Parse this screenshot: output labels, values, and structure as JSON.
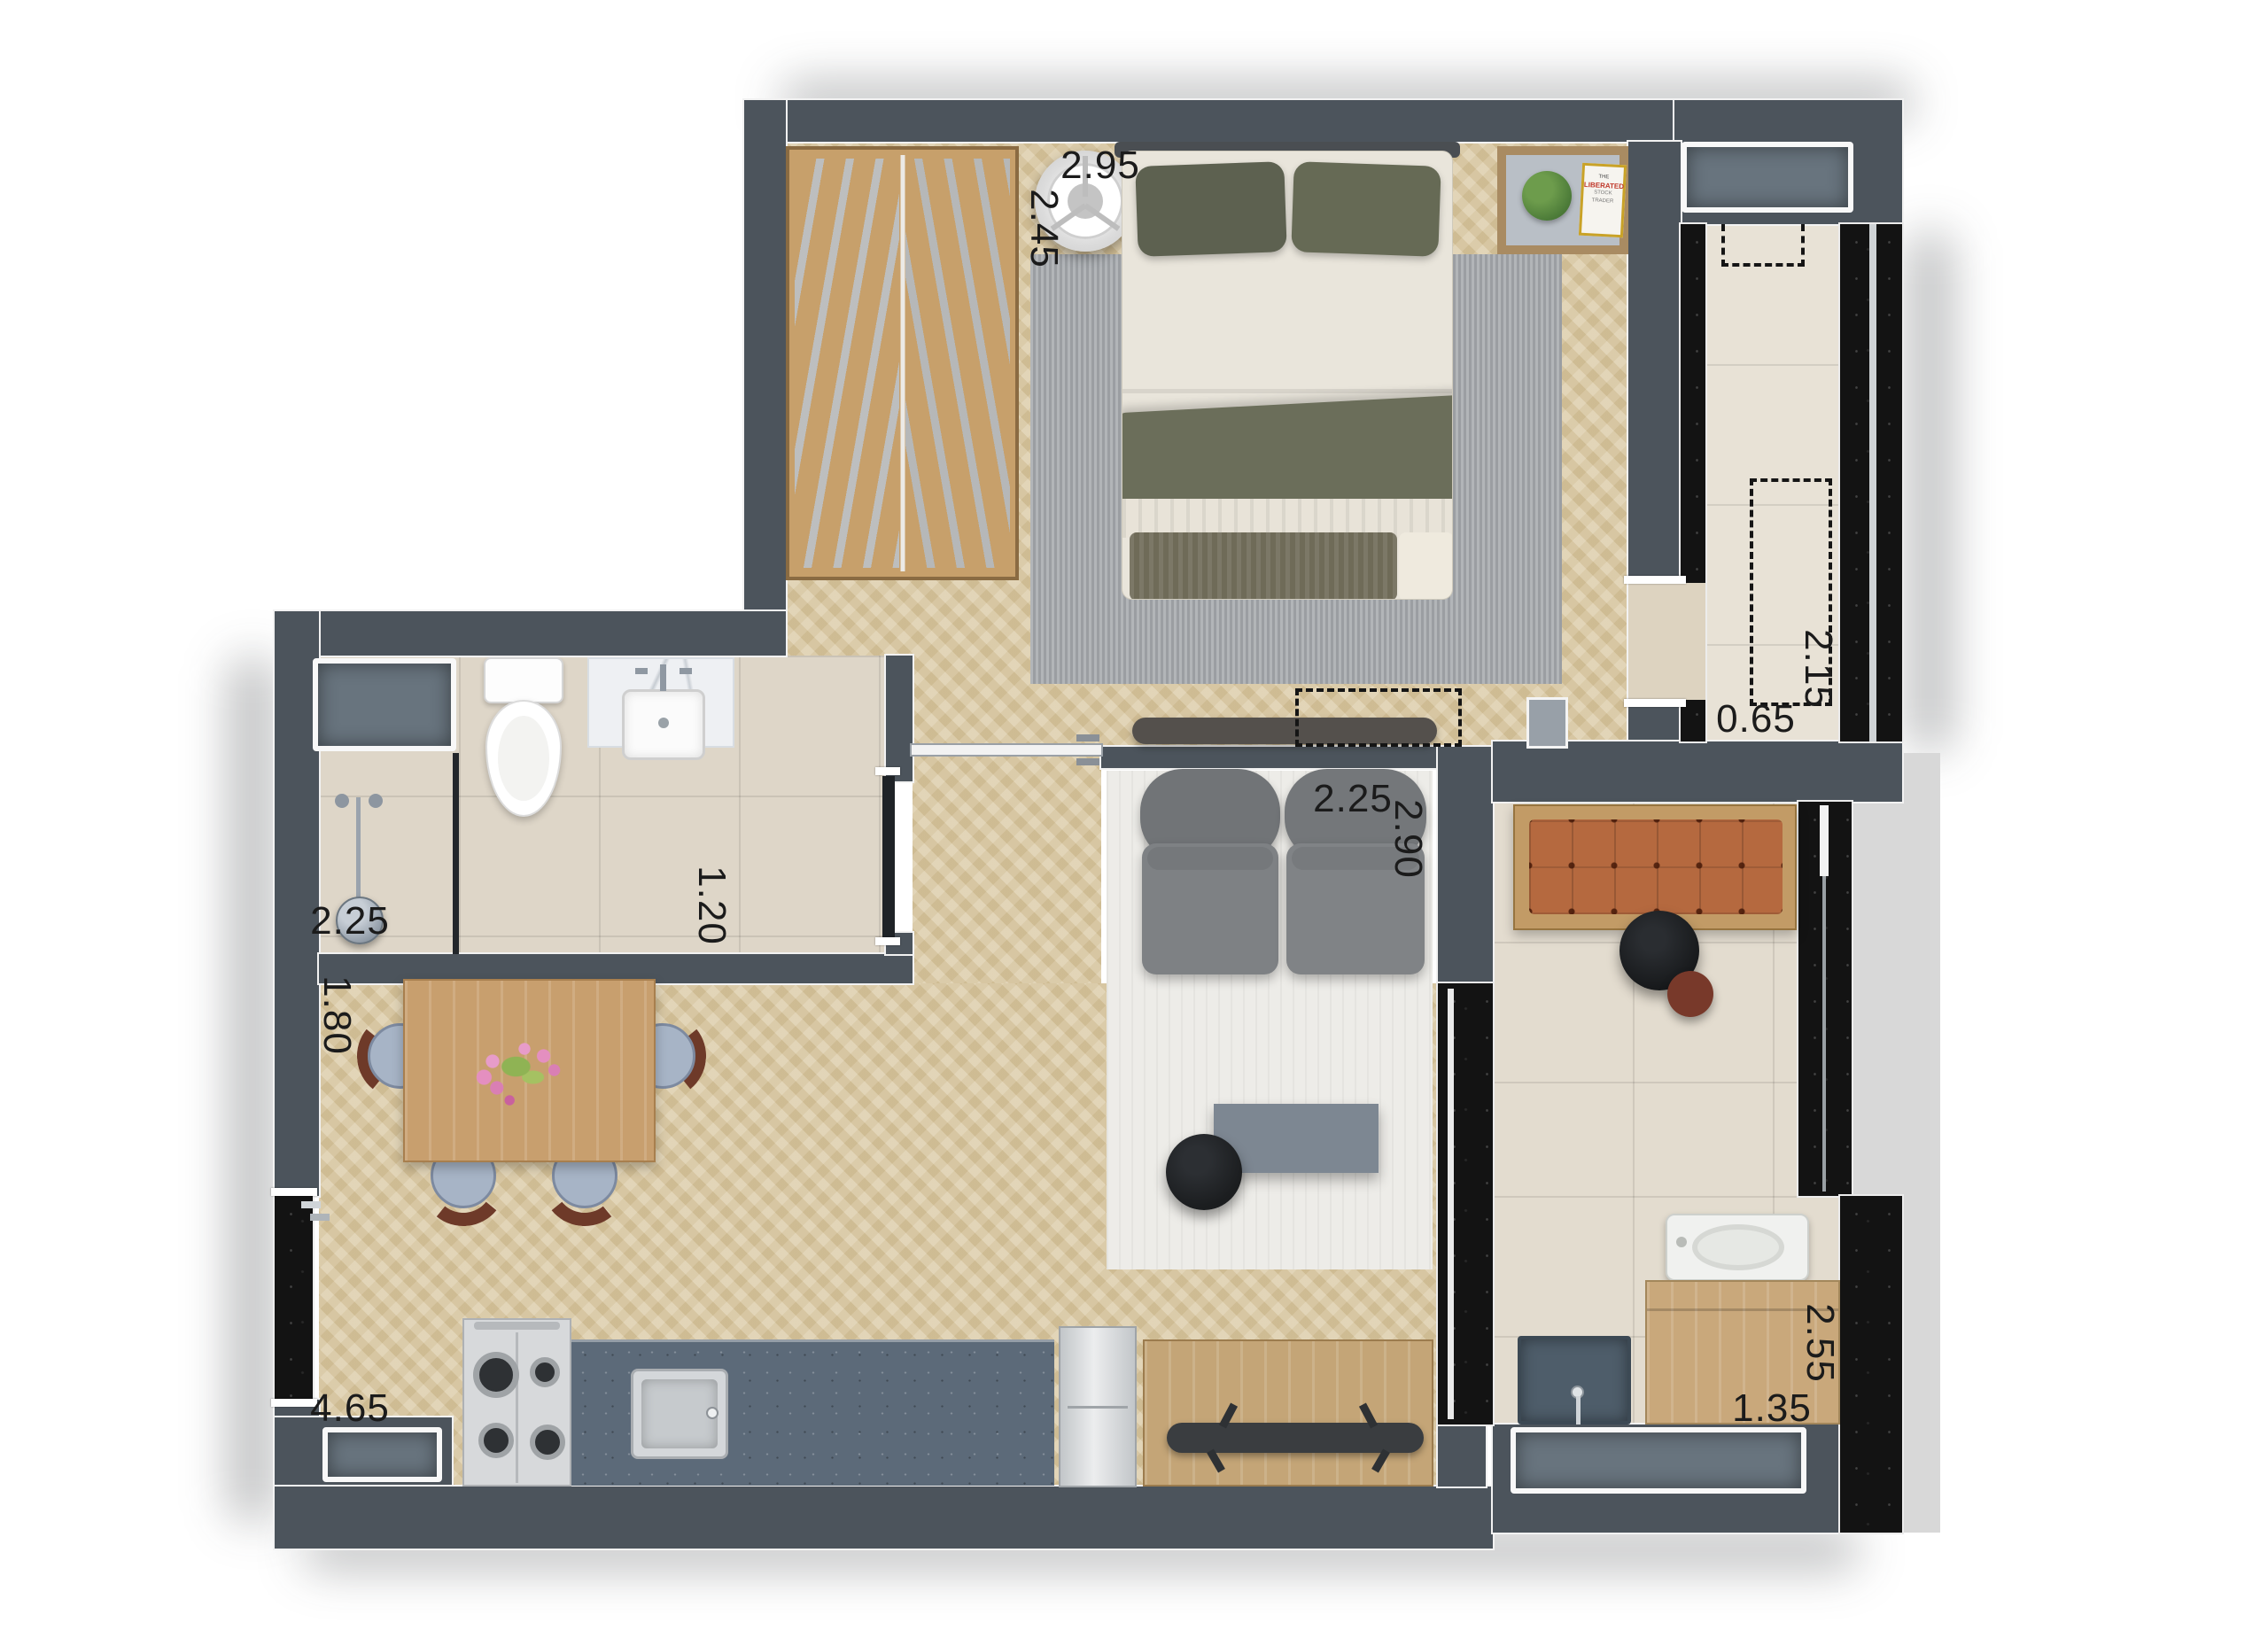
{
  "plan": {
    "dimensions": {
      "bedroom": {
        "width": "2.95",
        "depth": "2.45"
      },
      "tech_corridor": {
        "width": "0.65",
        "depth": "2.15"
      },
      "bathroom": {
        "width": "2.25",
        "depth": "1.20"
      },
      "dining": {
        "depth": "1.80"
      },
      "kitchen": {
        "width": "4.65"
      },
      "living": {
        "width": "2.25",
        "depth": "2.90"
      },
      "laundry": {
        "width": "1.35",
        "depth": "2.55"
      }
    },
    "book": {
      "line1": "THE",
      "line2": "LIBERATED",
      "line3": "STOCK TRADER"
    },
    "colors": {
      "wall": "#4c545c",
      "granite": "#131313",
      "wood_floor": "#d9c7a0",
      "tile": "#e3dccf",
      "bench_leather": "#b5693f",
      "sofa": "#7c7f82",
      "counter": "#5c6a79",
      "bedroom_rug": "#a3a7ab",
      "living_rug": "#edece8",
      "window_glass": "#68747e"
    }
  }
}
